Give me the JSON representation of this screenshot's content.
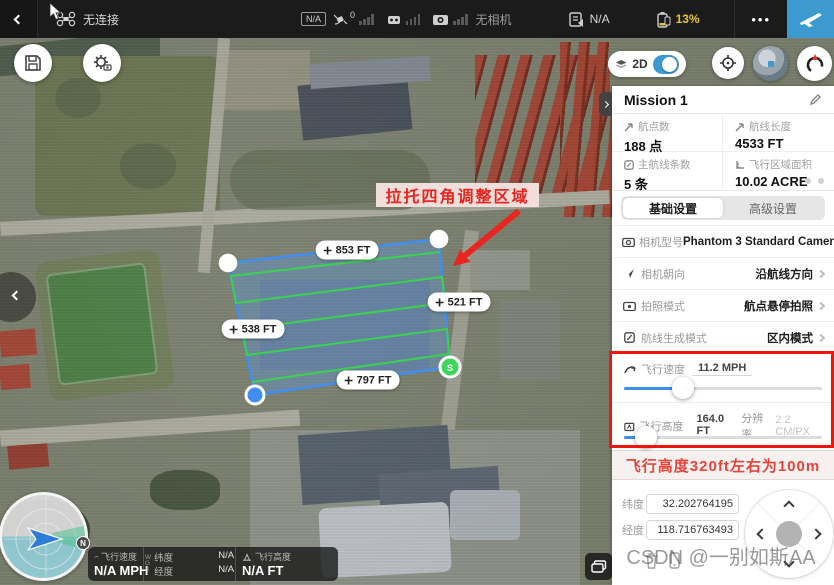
{
  "topbar": {
    "connection": "无连接",
    "gps_badge": "N/A",
    "satellite_count": "0",
    "camera_status": "无相机",
    "flight_mode": "N/A",
    "battery_percent": "13%",
    "more": "•••"
  },
  "map_overlay": {
    "view_mode": "2D",
    "annotation": "拉托四角调整区域",
    "edge_top": "853 FT",
    "edge_right": "521 FT",
    "edge_left": "538 FT",
    "edge_bottom": "797 FT",
    "start_marker": "S",
    "north": "N"
  },
  "telemetry_bar": {
    "speed_label": "飞行速度",
    "speed_value": "N/A MPH",
    "wgs": "W\nG\nS",
    "lat_label": "纬度",
    "lat_value": "N/A",
    "lng_label": "经度",
    "lng_value": "N/A",
    "alt_label": "飞行高度",
    "alt_value": "N/A FT"
  },
  "panel": {
    "title": "Mission 1",
    "stats": [
      {
        "label": "航点数",
        "value": "188 点"
      },
      {
        "label": "航线长度",
        "value": "4533 FT"
      },
      {
        "label": "主航线条数",
        "value": "5 条"
      },
      {
        "label": "飞行区域面积",
        "value": "10.02 ACRE"
      }
    ],
    "tabs": [
      {
        "label": "基础设置"
      },
      {
        "label": "高级设置"
      }
    ],
    "settings": [
      {
        "label": "相机型号",
        "value": "Phantom 3 Standard Camera"
      },
      {
        "label": "相机朝向",
        "value": "沿航线方向"
      },
      {
        "label": "拍照模式",
        "value": "航点悬停拍照"
      },
      {
        "label": "航线生成模式",
        "value": "区内模式"
      }
    ],
    "speed": {
      "label": "飞行速度",
      "value": "11.2 MPH"
    },
    "altitude": {
      "label": "飞行高度",
      "value": "164.0 FT",
      "res_label": "分辨率",
      "res_value": "2.2 CM/PX"
    },
    "tip": "飞行高度320ft左右为100m",
    "coords": {
      "lat_label": "纬度",
      "lat_value": "32.202764195",
      "lng_label": "经度",
      "lng_value": "118.716763493"
    }
  },
  "watermark": "CSDN @一别如斯AA",
  "colors": {
    "accent_blue": "#3D9AD1",
    "battery_yellow": "#E7C429",
    "alert_red": "#E8251F",
    "polygon_blue": "#3F8EF0",
    "route_green": "#39D34F"
  }
}
